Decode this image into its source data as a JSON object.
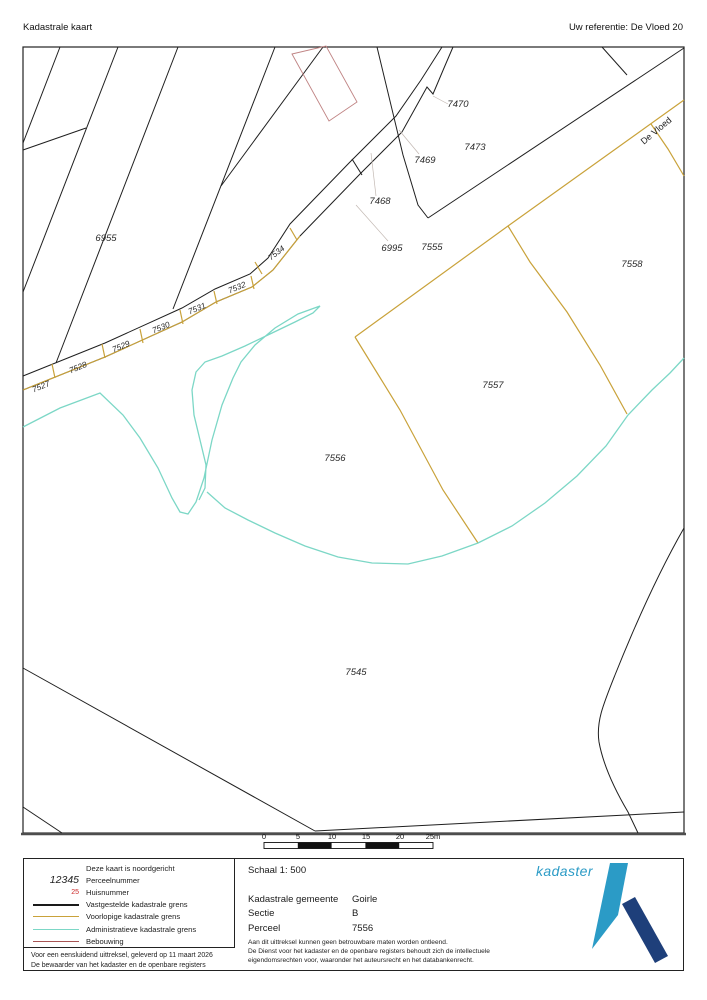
{
  "header": {
    "title": "Kadastrale kaart",
    "reference": "Uw referentie: De Vloed 20"
  },
  "map": {
    "street_name": "De Vloed",
    "parcel_labels": [
      "6955",
      "6995",
      "7555",
      "7558",
      "7473",
      "7469",
      "7470",
      "7468",
      "7557",
      "7556",
      "7545"
    ],
    "strip_labels": [
      "7527",
      "7528",
      "7529",
      "7530",
      "7531",
      "7532",
      "7534"
    ]
  },
  "scale_bar": {
    "ticks": [
      "0",
      "5",
      "10",
      "15",
      "20",
      "25m"
    ]
  },
  "legend": {
    "items": [
      {
        "sample": "",
        "label": "Deze kaart is noordgericht"
      },
      {
        "sample": "12345",
        "label": "Perceelnummer"
      },
      {
        "sample": "25",
        "label": "Huisnummer"
      },
      {
        "sample": "line-black",
        "label": "Vastgestelde kadastrale grens"
      },
      {
        "sample": "line-gold",
        "label": "Voorlopige kadastrale grens"
      },
      {
        "sample": "line-teal",
        "label": "Administratieve kadastrale grens"
      },
      {
        "sample": "line-red",
        "label": "Bebouwing"
      }
    ],
    "footer": [
      "Voor een eensluidend uittreksel, geleverd op 11 maart 2026",
      "De bewaarder van het kadaster en de openbare registers"
    ]
  },
  "details": {
    "scale_text": "Schaal 1: 500",
    "fields": [
      {
        "label": "Kadastrale gemeente",
        "value": "Goirle"
      },
      {
        "label": "Sectie",
        "value": "B"
      },
      {
        "label": "Perceel",
        "value": "7556"
      }
    ],
    "disclaimer": [
      "Aan dit uittreksel kunnen geen betrouwbare maten worden ontleend.",
      "De Dienst voor het kadaster en de openbare registers behoudt zich de intellectuele",
      "eigendomsrechten voor, waaronder het auteursrecht en het databankenrecht."
    ]
  },
  "logo": {
    "text": "kadaster"
  },
  "colors": {
    "vastgestelde_grens": "#1a1a1a",
    "voorlopige_grens": "#c9a23a",
    "administratieve_grens": "#7cd7c6",
    "bebouwing": "#a85454",
    "huisnummer": "#cc2a2a",
    "logo_light_blue": "#2b9bc6",
    "logo_dark_blue": "#1e3f7a"
  }
}
